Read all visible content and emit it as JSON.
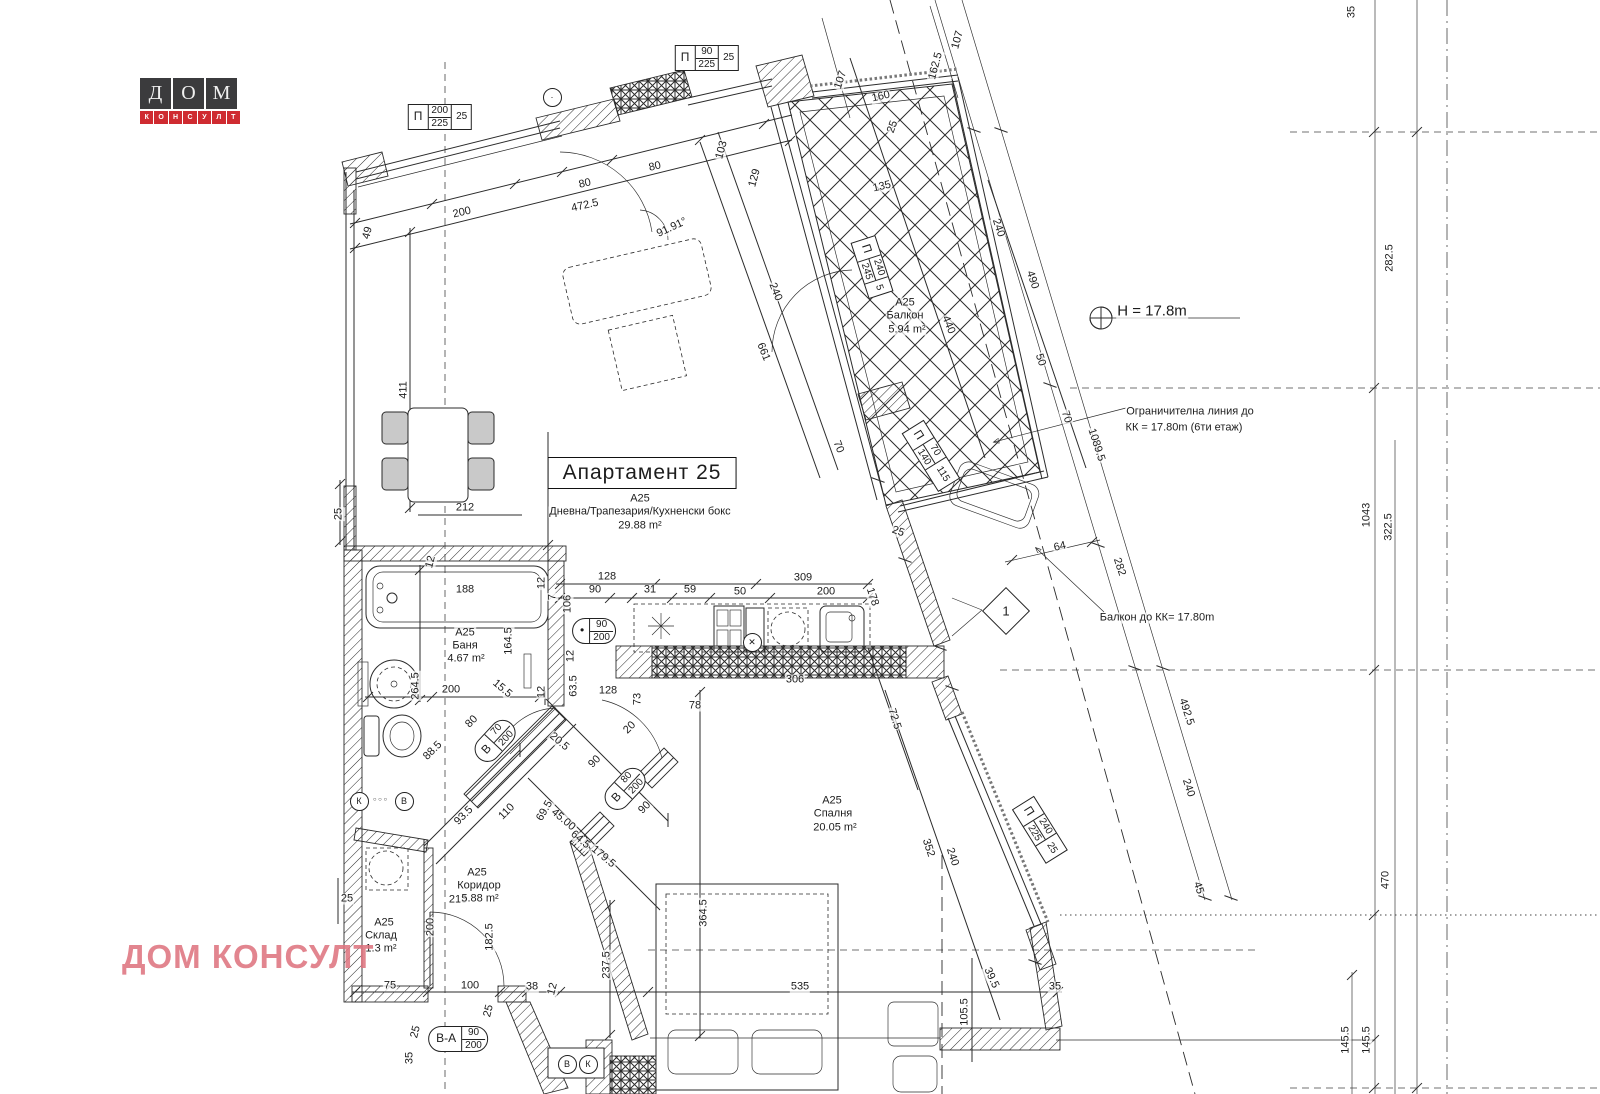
{
  "logo": {
    "letters": [
      "Д",
      "О",
      "М"
    ],
    "sub": "КОНСУЛТ"
  },
  "watermark": "ДОМ КОНСУЛТ",
  "title_box": "Апартамент 25",
  "colors": {
    "line": "#2b2b2b",
    "logo_red": "#cf2b31",
    "logo_dark": "#3b3b3d",
    "watermark": "#de747f"
  },
  "labels": [
    {
      "t": "49",
      "x": 368,
      "y": 233,
      "r": -75
    },
    {
      "t": "200",
      "x": 462,
      "y": 213,
      "r": -13
    },
    {
      "t": "80",
      "x": 585,
      "y": 184,
      "r": -13
    },
    {
      "t": "80",
      "x": 655,
      "y": 167,
      "r": -13
    },
    {
      "t": "472.5",
      "x": 585,
      "y": 206,
      "r": -13
    },
    {
      "t": "103",
      "x": 722,
      "y": 150,
      "r": -75
    },
    {
      "t": "129",
      "x": 755,
      "y": 178,
      "r": -75
    },
    {
      "t": "91.91°",
      "x": 672,
      "y": 228,
      "r": -25
    },
    {
      "t": "107",
      "x": 841,
      "y": 80,
      "r": -72
    },
    {
      "t": "160",
      "x": 881,
      "y": 97,
      "r": -13
    },
    {
      "t": "25",
      "x": 893,
      "y": 127,
      "r": -70
    },
    {
      "t": "135",
      "x": 882,
      "y": 187,
      "r": -13
    },
    {
      "t": "107",
      "x": 958,
      "y": 40,
      "r": -75
    },
    {
      "t": "162.5",
      "x": 936,
      "y": 66,
      "r": -75
    },
    {
      "t": "35",
      "x": 1352,
      "y": 12,
      "r": -90
    },
    {
      "t": "240",
      "x": 998,
      "y": 228,
      "r": 72
    },
    {
      "t": "490",
      "x": 1032,
      "y": 280,
      "r": 72
    },
    {
      "t": "440",
      "x": 948,
      "y": 325,
      "r": 68
    },
    {
      "t": "240",
      "x": 775,
      "y": 292,
      "r": 68
    },
    {
      "t": "661",
      "x": 763,
      "y": 352,
      "r": 68
    },
    {
      "t": "50",
      "x": 1040,
      "y": 360,
      "r": 72
    },
    {
      "t": "70",
      "x": 1066,
      "y": 417,
      "r": 72
    },
    {
      "t": "70",
      "x": 838,
      "y": 447,
      "r": 68
    },
    {
      "t": "1089.5",
      "x": 1096,
      "y": 445,
      "r": 72
    },
    {
      "t": "H = 17.8m",
      "x": 1152,
      "y": 311,
      "s": 15,
      "n": "height-annotation"
    },
    {
      "t": "Ограничителна линия до",
      "x": 1190,
      "y": 412,
      "n": "annotation"
    },
    {
      "t": "КК = 17.80m (6ти етаж)",
      "x": 1184,
      "y": 428,
      "n": "annotation"
    },
    {
      "t": "64",
      "x": 1060,
      "y": 547,
      "r": -13
    },
    {
      "t": "282",
      "x": 1119,
      "y": 567,
      "r": 72
    },
    {
      "t": "Балкон до КК= 17.80m",
      "x": 1157,
      "y": 618,
      "n": "annotation"
    },
    {
      "t": "492.5",
      "x": 1186,
      "y": 712,
      "r": 72
    },
    {
      "t": "240",
      "x": 1188,
      "y": 788,
      "r": 72
    },
    {
      "t": "45",
      "x": 1198,
      "y": 888,
      "r": 72
    },
    {
      "t": "25",
      "x": 898,
      "y": 532,
      "r": 20
    },
    {
      "t": "178",
      "x": 872,
      "y": 597,
      "r": 72
    },
    {
      "t": "72.5",
      "x": 894,
      "y": 719,
      "r": 72
    },
    {
      "t": "352",
      "x": 928,
      "y": 848,
      "r": 72
    },
    {
      "t": "240",
      "x": 952,
      "y": 857,
      "r": 72
    },
    {
      "t": "282.5",
      "x": 1390,
      "y": 258,
      "r": -90
    },
    {
      "t": "1043",
      "x": 1367,
      "y": 515,
      "r": -90
    },
    {
      "t": "322.5",
      "x": 1389,
      "y": 527,
      "r": -90
    },
    {
      "t": "470",
      "x": 1386,
      "y": 880,
      "r": -90
    },
    {
      "t": "145.5",
      "x": 1346,
      "y": 1040,
      "r": -90
    },
    {
      "t": "145.5",
      "x": 1367,
      "y": 1040,
      "r": -90
    },
    {
      "t": "128",
      "x": 607,
      "y": 577
    },
    {
      "t": "90",
      "x": 595,
      "y": 590
    },
    {
      "t": "31",
      "x": 650,
      "y": 590
    },
    {
      "t": "59",
      "x": 690,
      "y": 590
    },
    {
      "t": "50",
      "x": 740,
      "y": 592
    },
    {
      "t": "309",
      "x": 803,
      "y": 578
    },
    {
      "t": "200",
      "x": 826,
      "y": 592
    },
    {
      "t": "106",
      "x": 568,
      "y": 604,
      "r": -90
    },
    {
      "t": "12",
      "x": 571,
      "y": 656,
      "r": -90
    },
    {
      "t": "А25",
      "x": 640,
      "y": 499,
      "n": "room-label"
    },
    {
      "t": "Дневна/Трапезария/Кухненски бокс",
      "x": 640,
      "y": 512,
      "n": "room-label"
    },
    {
      "t": "29.88 m²",
      "x": 640,
      "y": 526,
      "n": "room-label"
    },
    {
      "t": "212",
      "x": 465,
      "y": 508
    },
    {
      "t": "411",
      "x": 404,
      "y": 390,
      "r": -90
    },
    {
      "t": "25",
      "x": 339,
      "y": 514,
      "r": -90
    },
    {
      "t": "А25",
      "x": 905,
      "y": 303,
      "n": "room-label"
    },
    {
      "t": "Балкон",
      "x": 905,
      "y": 316,
      "n": "room-label"
    },
    {
      "t": "5.94 m²",
      "x": 907,
      "y": 330,
      "n": "room-label"
    },
    {
      "t": "188",
      "x": 465,
      "y": 590
    },
    {
      "t": "12",
      "x": 431,
      "y": 562,
      "r": -75
    },
    {
      "t": "164.5",
      "x": 509,
      "y": 641,
      "r": -90
    },
    {
      "t": "264.5",
      "x": 416,
      "y": 686,
      "r": -90
    },
    {
      "t": "200",
      "x": 451,
      "y": 690
    },
    {
      "t": "15.5",
      "x": 502,
      "y": 689,
      "r": 40
    },
    {
      "t": "12",
      "x": 542,
      "y": 583,
      "r": -90
    },
    {
      "t": "7",
      "x": 553,
      "y": 597,
      "r": -90
    },
    {
      "t": "12",
      "x": 542,
      "y": 692,
      "r": -90
    },
    {
      "t": "А25",
      "x": 465,
      "y": 633,
      "n": "room-label"
    },
    {
      "t": "Баня",
      "x": 465,
      "y": 646,
      "n": "room-label"
    },
    {
      "t": "4.67 m²",
      "x": 466,
      "y": 659,
      "n": "room-label"
    },
    {
      "t": "88.5",
      "x": 433,
      "y": 751,
      "r": -45
    },
    {
      "t": "80",
      "x": 472,
      "y": 722,
      "r": -45
    },
    {
      "t": "93.5",
      "x": 464,
      "y": 816,
      "r": -45
    },
    {
      "t": "110",
      "x": 507,
      "y": 812,
      "r": -45
    },
    {
      "t": "20.5",
      "x": 559,
      "y": 742,
      "r": 40
    },
    {
      "t": "63.5",
      "x": 574,
      "y": 686,
      "r": -90
    },
    {
      "t": "128",
      "x": 608,
      "y": 691
    },
    {
      "t": "73",
      "x": 638,
      "y": 699,
      "r": -90
    },
    {
      "t": "20",
      "x": 630,
      "y": 728,
      "r": -45
    },
    {
      "t": "90",
      "x": 595,
      "y": 762,
      "r": -45
    },
    {
      "t": "90",
      "x": 645,
      "y": 808,
      "r": -45
    },
    {
      "t": "69.5",
      "x": 545,
      "y": 811,
      "r": -60
    },
    {
      "t": "45.00",
      "x": 563,
      "y": 820,
      "r": 40
    },
    {
      "t": "64.5",
      "x": 580,
      "y": 840,
      "r": 40
    },
    {
      "t": "179.5",
      "x": 603,
      "y": 857,
      "r": 40
    },
    {
      "t": "213",
      "x": 458,
      "y": 900
    },
    {
      "t": "200",
      "x": 431,
      "y": 927,
      "r": -90
    },
    {
      "t": "25",
      "x": 347,
      "y": 899
    },
    {
      "t": "182.5",
      "x": 490,
      "y": 937,
      "r": -90
    },
    {
      "t": "237.5",
      "x": 607,
      "y": 965,
      "r": -90
    },
    {
      "t": "А25",
      "x": 477,
      "y": 873,
      "n": "room-label"
    },
    {
      "t": "Коридор",
      "x": 479,
      "y": 886,
      "n": "room-label"
    },
    {
      "t": "5.88 m²",
      "x": 480,
      "y": 899,
      "n": "room-label"
    },
    {
      "t": "А25",
      "x": 384,
      "y": 923,
      "n": "room-label"
    },
    {
      "t": "Склад",
      "x": 381,
      "y": 936,
      "n": "room-label"
    },
    {
      "t": "1.3 m²",
      "x": 381,
      "y": 949,
      "n": "room-label"
    },
    {
      "t": "75",
      "x": 390,
      "y": 986
    },
    {
      "t": "100",
      "x": 470,
      "y": 986
    },
    {
      "t": "38",
      "x": 532,
      "y": 987
    },
    {
      "t": "12",
      "x": 553,
      "y": 989,
      "r": -75
    },
    {
      "t": "25",
      "x": 416,
      "y": 1032,
      "r": -75
    },
    {
      "t": "35",
      "x": 410,
      "y": 1058,
      "r": -90
    },
    {
      "t": "25",
      "x": 489,
      "y": 1011,
      "r": -75
    },
    {
      "t": "535",
      "x": 800,
      "y": 987
    },
    {
      "t": "364.5",
      "x": 704,
      "y": 913,
      "r": -90
    },
    {
      "t": "105.5",
      "x": 965,
      "y": 1012,
      "r": -90
    },
    {
      "t": "39.5",
      "x": 991,
      "y": 978,
      "r": 65
    },
    {
      "t": "35",
      "x": 1055,
      "y": 987
    },
    {
      "t": "306",
      "x": 795,
      "y": 680
    },
    {
      "t": "78",
      "x": 695,
      "y": 706
    },
    {
      "t": "А25",
      "x": 832,
      "y": 801,
      "n": "room-label"
    },
    {
      "t": "Спалня",
      "x": 833,
      "y": 814,
      "n": "room-label"
    },
    {
      "t": "20.05 m²",
      "x": 835,
      "y": 828,
      "n": "room-label"
    },
    {
      "t": "○ ○ ○",
      "x": 380,
      "y": 800,
      "s": 6
    }
  ],
  "tags": {
    "boxes": [
      {
        "x": 440,
        "y": 117,
        "r": 0,
        "p": "П",
        "num": "200",
        "den": "225",
        "last": "25"
      },
      {
        "x": 707,
        "y": 58,
        "r": 0,
        "p": "П",
        "num": "90",
        "den": "225",
        "last": "25"
      },
      {
        "x": 872,
        "y": 267,
        "r": 72,
        "p": "П",
        "num": "240",
        "den": "245",
        "last": "5"
      },
      {
        "x": 931,
        "y": 456,
        "r": 58,
        "p": "П",
        "num": "70",
        "den": "140",
        "last": "115"
      },
      {
        "x": 1040,
        "y": 830,
        "r": 58,
        "p": "П",
        "num": "240",
        "den": "225",
        "last": "25"
      }
    ],
    "ovals": [
      {
        "x": 495,
        "y": 741,
        "r": -47,
        "p": "В",
        "num": "70",
        "den": "200"
      },
      {
        "x": 625,
        "y": 789,
        "r": -47,
        "p": "В",
        "num": "80",
        "den": "200"
      },
      {
        "x": 458,
        "y": 1039,
        "r": 0,
        "p": "В-А",
        "num": "90",
        "den": "200"
      },
      {
        "x": 594,
        "y": 631,
        "r": 0,
        "p": "•",
        "num": "90",
        "den": "200"
      }
    ],
    "diamond": {
      "x": 1005,
      "y": 610,
      "label": "1"
    },
    "circles": [
      {
        "x": 566,
        "y": 1063,
        "t": "В"
      },
      {
        "x": 587,
        "y": 1063,
        "t": "К"
      },
      {
        "x": 358,
        "y": 800,
        "t": "К"
      },
      {
        "x": 403,
        "y": 800,
        "t": "В"
      },
      {
        "x": 751,
        "y": 641,
        "t": "✕"
      },
      {
        "x": 551,
        "y": 96,
        "t": "·"
      }
    ]
  }
}
